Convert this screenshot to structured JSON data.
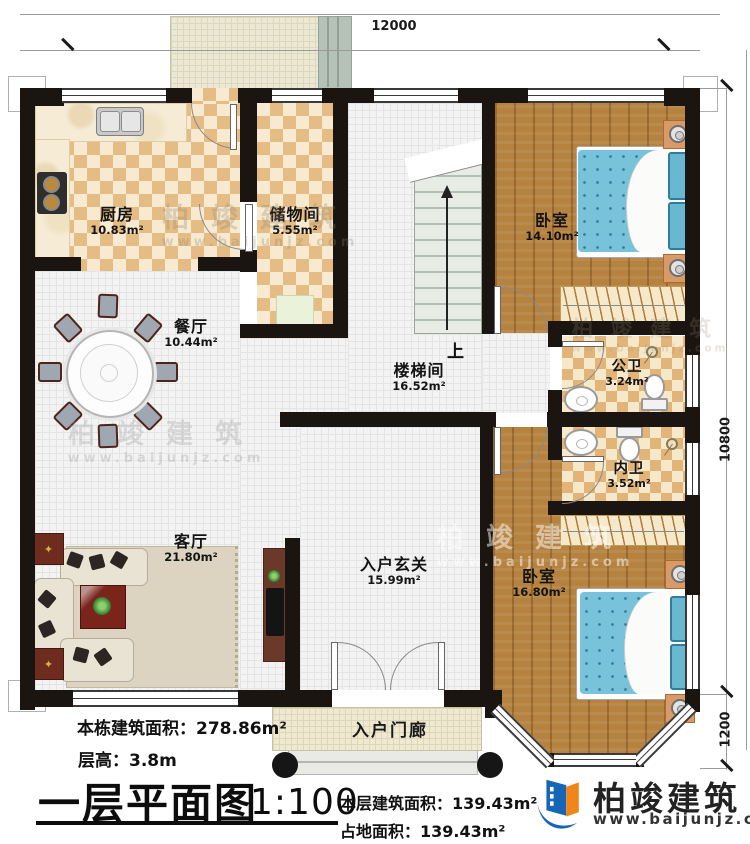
{
  "plan": {
    "dims": {
      "top": "12000",
      "right_upper": "10800",
      "right_lower": "1200"
    },
    "rooms": {
      "kitchen": {
        "name": "厨房",
        "area": "10.83m²"
      },
      "storage": {
        "name": "储物间",
        "area": "5.55m²"
      },
      "bedroom1": {
        "name": "卧室",
        "area": "14.10m²"
      },
      "dining": {
        "name": "餐厅",
        "area": "10.44m²"
      },
      "stairwell": {
        "name": "楼梯间",
        "area": "16.52m²"
      },
      "public_bath": {
        "name": "公卫",
        "area": "3.24m²"
      },
      "private_bath": {
        "name": "内卫",
        "area": "3.52m²"
      },
      "living": {
        "name": "客厅",
        "area": "21.80m²"
      },
      "foyer": {
        "name": "入户玄关",
        "area": "15.99m²"
      },
      "bedroom2": {
        "name": "卧室",
        "area": "16.80m²"
      },
      "porch": {
        "name": "入户门廊"
      }
    },
    "stairs_up_label": "上"
  },
  "titleblock": {
    "building_area_label": "本栋建筑面积：",
    "building_area": "278.86m²",
    "floor_height_label": "层高：",
    "floor_height": "3.8m",
    "title": "一层平面图",
    "scale": "1:100",
    "floor_area_label": "本层建筑面积：",
    "floor_area": "139.43m²",
    "land_area_label": "占地面积：",
    "land_area": "139.43m²"
  },
  "brand": {
    "name": "柏竣建筑",
    "website": "www.baijunjz.com"
  },
  "watermark": {
    "name": "柏竣建筑",
    "website": "www.baijunjz.com"
  },
  "colors": {
    "wall": "#1a1511",
    "checker_tan": "#e5bc83",
    "checker_cream": "#f7ead0",
    "wood_floor": "#b5823f",
    "bed_blue": "#79c3da",
    "brand_blue": "#1766b5",
    "brand_orange": "#f08519"
  }
}
